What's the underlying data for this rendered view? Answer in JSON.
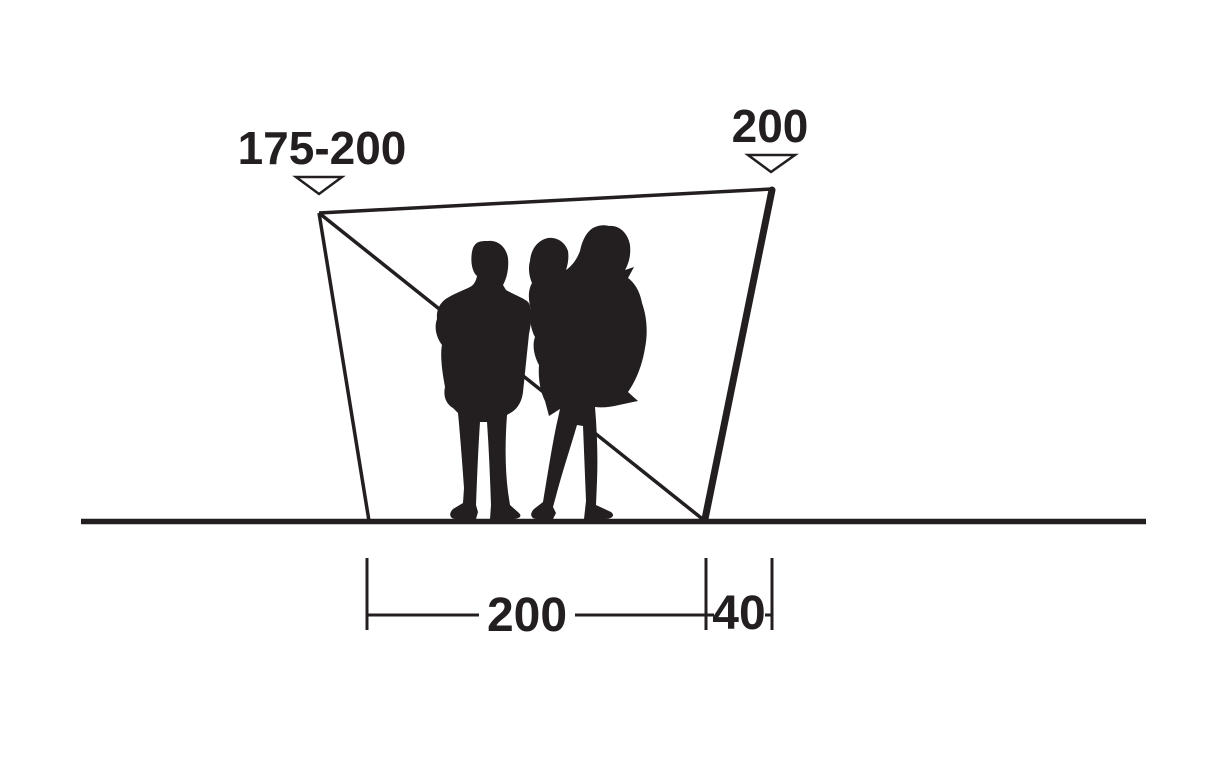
{
  "page": {
    "background_color": "#ffffff",
    "ink_color": "#231f20"
  },
  "diagram": {
    "subject": "tent-side-profile-dimension-diagram",
    "dimensions": {
      "front_height": {
        "label": "175-200",
        "position": "top-left"
      },
      "rear_pole_height": {
        "label": "200",
        "position": "top-right"
      },
      "floor_depth": {
        "label": "200",
        "position": "bottom"
      },
      "pole_offset": {
        "label": "40",
        "position": "bottom-right"
      }
    },
    "figures": [
      "adult-silhouette",
      "adult-carrying-child-silhouette"
    ]
  }
}
